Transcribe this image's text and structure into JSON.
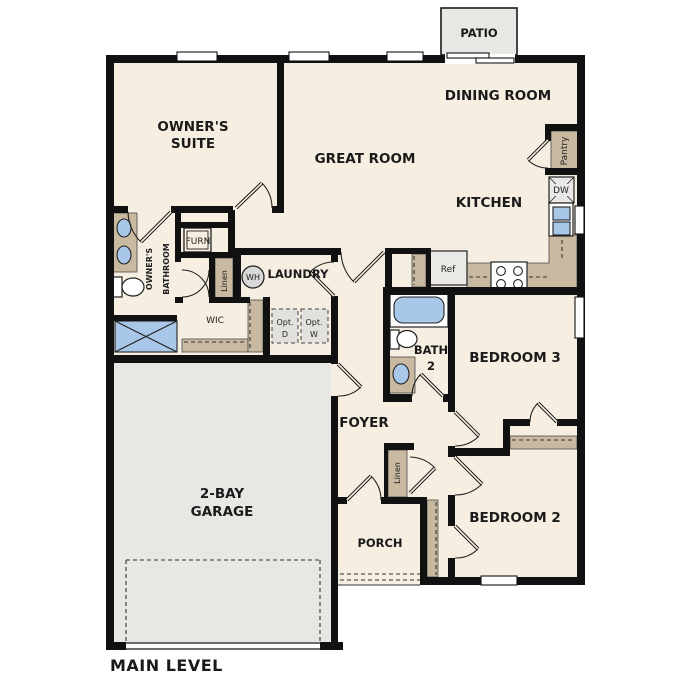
{
  "plan": {
    "level_label": "MAIN LEVEL",
    "rooms": {
      "owners_suite": {
        "line1": "OWNER'S",
        "line2": "SUITE"
      },
      "great_room": {
        "label": "GREAT ROOM"
      },
      "dining_room": {
        "label": "DINING ROOM"
      },
      "kitchen": {
        "label": "KITCHEN"
      },
      "laundry": {
        "label": "LAUNDRY"
      },
      "owners_bathroom": {
        "line1": "OWNER'S",
        "line2": "BATHROOM"
      },
      "wic": {
        "label": "WIC"
      },
      "bath2": {
        "line1": "BATH",
        "line2": "2"
      },
      "bedroom3": {
        "label": "BEDROOM 3"
      },
      "bedroom2": {
        "label": "BEDROOM 2"
      },
      "foyer": {
        "label": "FOYER"
      },
      "porch": {
        "label": "PORCH"
      },
      "patio": {
        "label": "PATIO"
      },
      "garage": {
        "line1": "2-BAY",
        "line2": "GARAGE"
      }
    },
    "fixtures": {
      "ref": "Ref",
      "dw": "DW",
      "wh": "WH",
      "furn": "FURN",
      "pantry": "Pantry",
      "linen_hall": "Linen",
      "linen_foyer": "Linen",
      "opt_d": {
        "line1": "Opt.",
        "line2": "D"
      },
      "opt_w": {
        "line1": "Opt.",
        "line2": "W"
      }
    },
    "colors": {
      "floor": "#f6eee1",
      "cabinet_tan": "#c9b9a0",
      "concrete_gray": "#e8e7e4",
      "fixture_blue": "#a9c7e8",
      "wall": "#111111"
    }
  }
}
